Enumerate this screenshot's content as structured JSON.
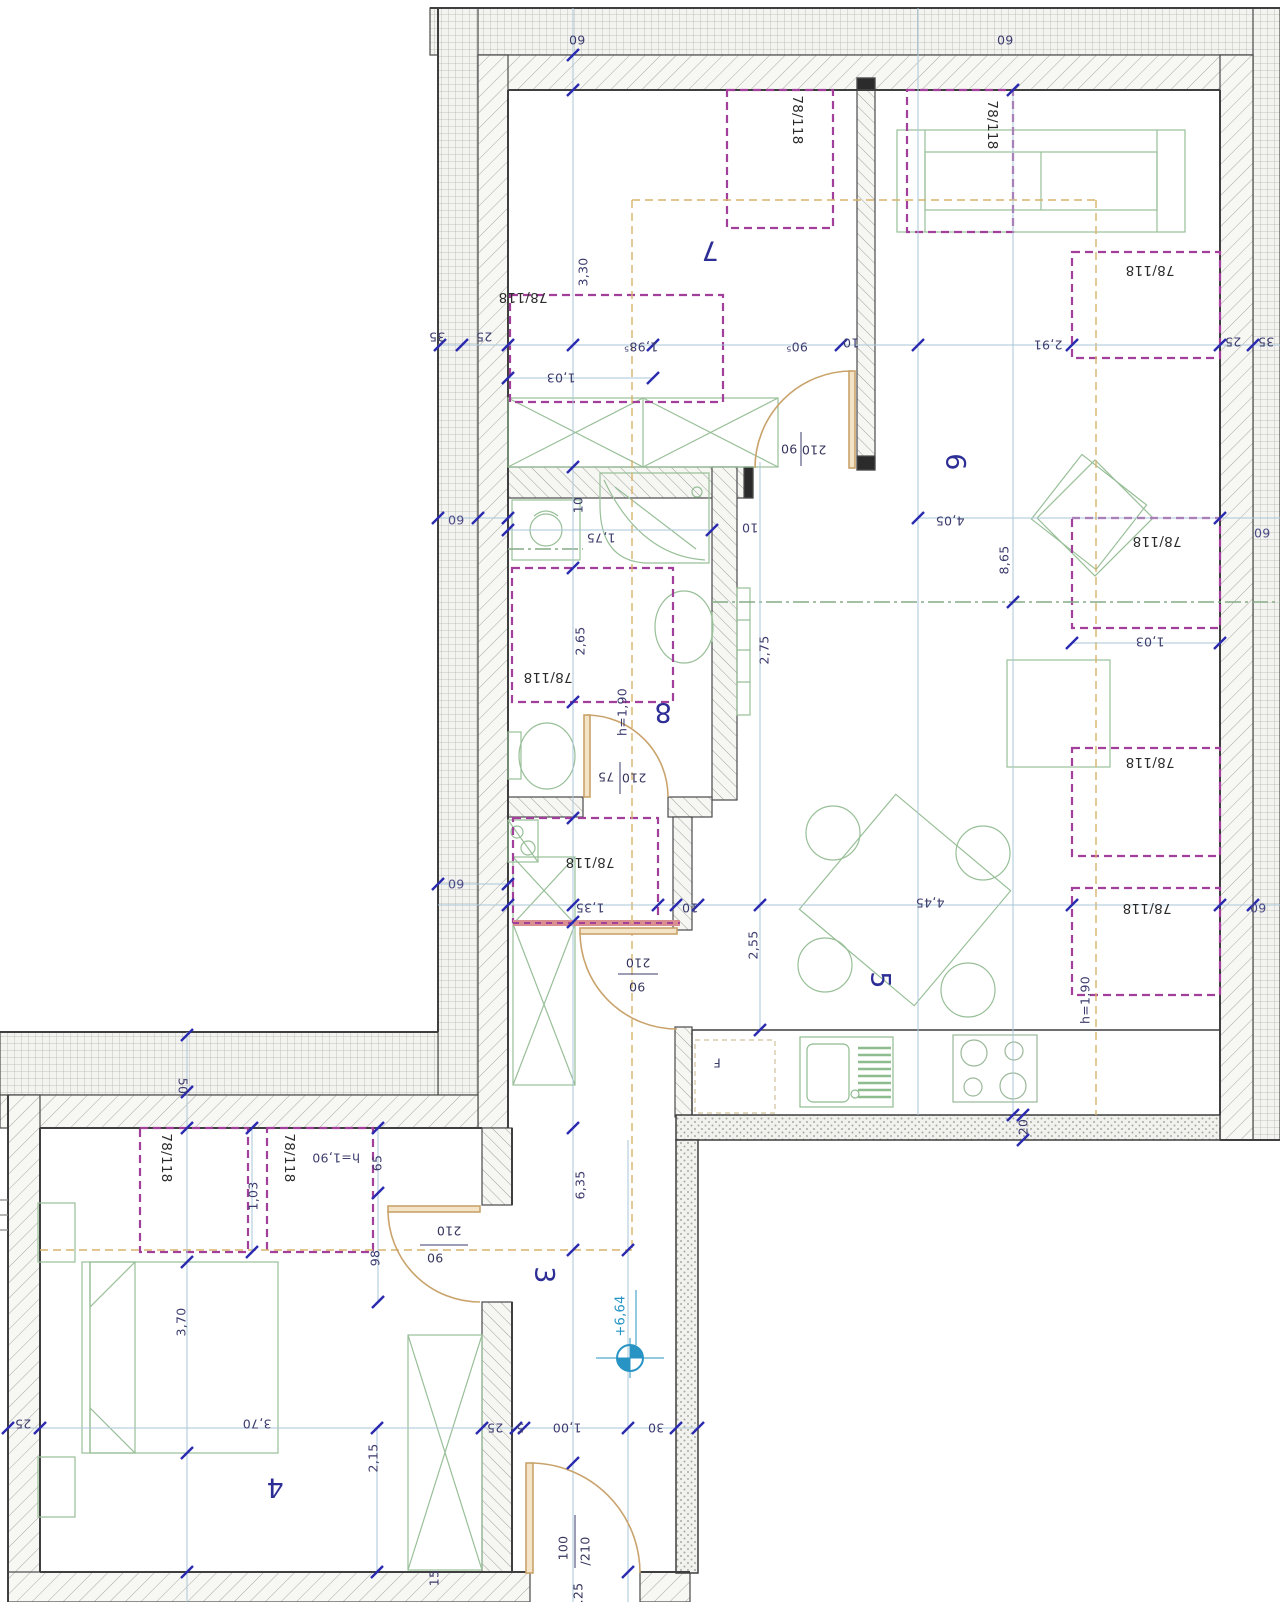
{
  "drawing": {
    "kind": "apartment floor plan (attic storey), scanned CAD drawing",
    "rooms_visible": [
      "3",
      "4",
      "5",
      "6",
      "7",
      "8"
    ],
    "roof_window_size": "78/118",
    "elevation_mark": "+6,64"
  },
  "colors": {
    "dimension_text": "#3b3b6e",
    "room_number": "#2d2d96",
    "window_dashed_magenta": "#a23f9b",
    "furniture_green": "#98bf98",
    "door_tan": "#c9a36b",
    "tick_blue": "#2a2ab0",
    "construction_line_blue": "#aac6d7",
    "elevation_blue": "#2794c4",
    "sill_red": "#d98f8f",
    "roof_line_orange": "#d9b36a",
    "section_line_green": "#85ab85",
    "wall_edge": "#4a4a4a"
  },
  "labels": [
    {
      "n": "dim-top-wall-60-left",
      "t": "60",
      "x": 577,
      "y": 40,
      "r": 180
    },
    {
      "n": "dim-top-wall-60-right",
      "t": "60",
      "x": 1005,
      "y": 40,
      "r": 180
    },
    {
      "n": "dim-band-35-left",
      "t": "35",
      "x": 437,
      "y": 337,
      "r": 180
    },
    {
      "n": "dim-band-25-left",
      "t": "25",
      "x": 484,
      "y": 337,
      "r": 180
    },
    {
      "n": "dim-band-25-right",
      "t": "25",
      "x": 1233,
      "y": 342,
      "r": 180
    },
    {
      "n": "dim-band-35-right",
      "t": "35",
      "x": 1266,
      "y": 342,
      "r": 180
    },
    {
      "n": "window-size-room7-right",
      "t": "78/118",
      "x": 797,
      "y": 120,
      "r": 90,
      "c": "win"
    },
    {
      "n": "window-size-room6-top",
      "t": "78/118",
      "x": 992,
      "y": 125,
      "r": 90,
      "c": "win"
    },
    {
      "n": "room-number-7",
      "t": "7",
      "x": 710,
      "y": 250,
      "r": 180,
      "c": "room"
    },
    {
      "n": "dim-3-30",
      "t": "3,30",
      "x": 583,
      "y": 272,
      "r": -90
    },
    {
      "n": "window-size-room7-left",
      "t": "78/118",
      "x": 523,
      "y": 297,
      "r": 180,
      "c": "win"
    },
    {
      "n": "dim-1-98-5",
      "t": "1,98⁵",
      "x": 641,
      "y": 347,
      "r": 180
    },
    {
      "n": "dim-1-03-room7",
      "t": "1,03",
      "x": 561,
      "y": 378,
      "r": 180
    },
    {
      "n": "dim-90-5",
      "t": "90⁵",
      "x": 797,
      "y": 347,
      "r": 180
    },
    {
      "n": "dim-10-wall-7-6",
      "t": "10",
      "x": 851,
      "y": 343,
      "r": 180
    },
    {
      "n": "dim-2-91",
      "t": "2,91",
      "x": 1048,
      "y": 345,
      "r": 180
    },
    {
      "n": "window-size-room6-right-upper",
      "t": "78/118",
      "x": 1150,
      "y": 270,
      "r": 180,
      "c": "win"
    },
    {
      "n": "door-label-90-room6",
      "t": "90",
      "x": 789,
      "y": 449,
      "r": 180,
      "c": "door"
    },
    {
      "n": "door-label-210-room6",
      "t": "210",
      "x": 814,
      "y": 450,
      "r": 180,
      "c": "door"
    },
    {
      "n": "room-number-6",
      "t": "6",
      "x": 955,
      "y": 462,
      "r": 90,
      "c": "room"
    },
    {
      "n": "dim-4-05",
      "t": "4,05",
      "x": 950,
      "y": 521,
      "r": 180
    },
    {
      "n": "dim-8-65",
      "t": "8,65",
      "x": 1004,
      "y": 560,
      "r": -90
    },
    {
      "n": "window-size-room6-right-lower",
      "t": "78/118",
      "x": 1157,
      "y": 541,
      "r": 180,
      "c": "win"
    },
    {
      "n": "dim-1-03-room6",
      "t": "1,03",
      "x": 1150,
      "y": 642,
      "r": 180
    },
    {
      "n": "dim-band-60-left-upper",
      "t": "60",
      "x": 456,
      "y": 520,
      "r": 180,
      "c": "band"
    },
    {
      "n": "dim-band-60-right-upper",
      "t": "60",
      "x": 1262,
      "y": 533,
      "r": 180,
      "c": "band"
    },
    {
      "n": "dim-band-60-left-lower",
      "t": "60",
      "x": 456,
      "y": 884,
      "r": 180,
      "c": "band"
    },
    {
      "n": "dim-band-60-right-lower",
      "t": "60",
      "x": 1258,
      "y": 908,
      "r": 180,
      "c": "band"
    },
    {
      "n": "dim-10-bath-left",
      "t": "10",
      "x": 578,
      "y": 505,
      "r": -90
    },
    {
      "n": "dim-10-bath-right",
      "t": "10",
      "x": 750,
      "y": 528,
      "r": 180
    },
    {
      "n": "dim-1-75",
      "t": "1,75",
      "x": 601,
      "y": 538,
      "r": 180
    },
    {
      "n": "dim-h-1-90-bath",
      "t": "h=1,90",
      "x": 622,
      "y": 712,
      "r": -90
    },
    {
      "n": "dim-2-65",
      "t": "2,65",
      "x": 580,
      "y": 641,
      "r": -90
    },
    {
      "n": "window-size-bath",
      "t": "78/118",
      "x": 548,
      "y": 677,
      "r": 180,
      "c": "win"
    },
    {
      "n": "room-number-8",
      "t": "8",
      "x": 663,
      "y": 712,
      "r": 180,
      "c": "room"
    },
    {
      "n": "dim-2-75",
      "t": "2,75",
      "x": 764,
      "y": 650,
      "r": -90
    },
    {
      "n": "door-label-75-bath",
      "t": "75",
      "x": 606,
      "y": 777,
      "r": 180,
      "c": "door"
    },
    {
      "n": "door-label-210-bath",
      "t": "210",
      "x": 634,
      "y": 778,
      "r": 180,
      "c": "door"
    },
    {
      "n": "door-label-210-hall",
      "t": "210",
      "x": 638,
      "y": 963,
      "r": 180,
      "c": "door"
    },
    {
      "n": "door-label-90-hall",
      "t": "90",
      "x": 637,
      "y": 987,
      "r": 180,
      "c": "door"
    },
    {
      "n": "dim-1-35",
      "t": "1,35",
      "x": 590,
      "y": 908,
      "r": 180
    },
    {
      "n": "dim-10-niche",
      "t": "10",
      "x": 690,
      "y": 908,
      "r": 180
    },
    {
      "n": "window-size-niche",
      "t": "78/118",
      "x": 590,
      "y": 862,
      "r": 180,
      "c": "win"
    },
    {
      "n": "room-number-5",
      "t": "5",
      "x": 880,
      "y": 980,
      "r": 90,
      "c": "room"
    },
    {
      "n": "dim-4-45",
      "t": "4,45",
      "x": 930,
      "y": 903,
      "r": 180
    },
    {
      "n": "dim-2-55",
      "t": "2,55",
      "x": 753,
      "y": 945,
      "r": -90
    },
    {
      "n": "window-size-room5-upper",
      "t": "78/118",
      "x": 1150,
      "y": 762,
      "r": 180,
      "c": "win"
    },
    {
      "n": "window-size-room5-lower",
      "t": "78/118",
      "x": 1147,
      "y": 908,
      "r": 180,
      "c": "win"
    },
    {
      "n": "dim-h-1-90-room5",
      "t": "h=1,90",
      "x": 1085,
      "y": 1000,
      "r": -90
    },
    {
      "n": "fridge-label",
      "t": "F",
      "x": 717,
      "y": 1063,
      "r": 180
    },
    {
      "n": "dim-20",
      "t": "20",
      "x": 1023,
      "y": 1127,
      "r": -90
    },
    {
      "n": "dim-50-band",
      "t": "50",
      "x": 183,
      "y": 1086,
      "r": 90
    },
    {
      "n": "window-size-room4-left",
      "t": "78/118",
      "x": 166,
      "y": 1158,
      "r": 90,
      "c": "win"
    },
    {
      "n": "dim-1-03-room4",
      "t": "1,03",
      "x": 253,
      "y": 1196,
      "r": -90
    },
    {
      "n": "window-size-room4-right",
      "t": "78/118",
      "x": 289,
      "y": 1158,
      "r": 90,
      "c": "win"
    },
    {
      "n": "dim-h-1-90-room4",
      "t": "h=1,90",
      "x": 336,
      "y": 1158,
      "r": 180
    },
    {
      "n": "dim-65",
      "t": "65",
      "x": 377,
      "y": 1163,
      "r": -90
    },
    {
      "n": "dim-98",
      "t": "98",
      "x": 375,
      "y": 1258,
      "r": -90
    },
    {
      "n": "door-label-210-room4",
      "t": "210",
      "x": 449,
      "y": 1231,
      "r": 180,
      "c": "door"
    },
    {
      "n": "door-label-90-room4",
      "t": "90",
      "x": 435,
      "y": 1258,
      "r": 180,
      "c": "door"
    },
    {
      "n": "dim-3-70-vertical",
      "t": "3,70",
      "x": 181,
      "y": 1322,
      "r": -90
    },
    {
      "n": "room-number-4",
      "t": "4",
      "x": 275,
      "y": 1487,
      "r": 180,
      "c": "room"
    },
    {
      "n": "dim-3-70-horizontal",
      "t": "3,70",
      "x": 257,
      "y": 1424,
      "r": 180
    },
    {
      "n": "dim-25-left-wall",
      "t": "25",
      "x": 23,
      "y": 1424,
      "r": 180
    },
    {
      "n": "dim-2-15",
      "t": "2,15",
      "x": 373,
      "y": 1458,
      "r": -90
    },
    {
      "n": "dim-15",
      "t": "15",
      "x": 434,
      "y": 1578,
      "r": -90
    },
    {
      "n": "dim-6-35",
      "t": "6,35",
      "x": 580,
      "y": 1185,
      "r": -90
    },
    {
      "n": "room-number-3",
      "t": "3",
      "x": 544,
      "y": 1275,
      "r": 90,
      "c": "room"
    },
    {
      "n": "elevation-value",
      "t": "+6,64",
      "x": 621,
      "y": 1316,
      "r": -90,
      "c": "blue"
    },
    {
      "n": "dim-25-hall",
      "t": "25",
      "x": 495,
      "y": 1428,
      "r": 180
    },
    {
      "n": "dim-5-hall",
      "t": "5",
      "x": 520,
      "y": 1428,
      "r": 180
    },
    {
      "n": "dim-1-00",
      "t": "1,00",
      "x": 567,
      "y": 1428,
      "r": 180
    },
    {
      "n": "dim-30",
      "t": "30",
      "x": 656,
      "y": 1428,
      "r": 180
    },
    {
      "n": "door-label-100-entry",
      "t": "100",
      "x": 563,
      "y": 1548,
      "r": -90,
      "c": "door"
    },
    {
      "n": "door-label-210-entry",
      "t": "/210",
      "x": 585,
      "y": 1551,
      "r": -90,
      "c": "door"
    },
    {
      "n": "door-label-25-entry",
      "t": ".25",
      "x": 578,
      "y": 1593,
      "r": -90,
      "c": "door"
    }
  ]
}
